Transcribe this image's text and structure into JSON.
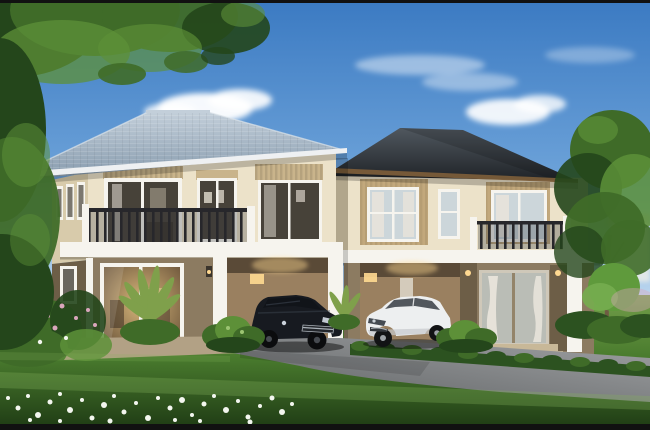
{
  "meta": {
    "title": "Architectural rendering: twin two-storey houses with carports",
    "width": 650,
    "height": 430
  },
  "scene": {
    "objects": [
      "blue sky with clouds",
      "overhanging tree top-left",
      "left two-storey house with light blue-grey hip roof and balcony",
      "right two-storey house with dark charcoal hip roof and balcony",
      "black sedan parked in left carport",
      "white sedan parked in right carport",
      "glowing glass sliding doors",
      "green lawn with white flower bed",
      "grey driveway with hedge row",
      "garden shrubs and tree on right"
    ]
  },
  "colors": {
    "border": "#111111",
    "sky_top": "#3b7ac2",
    "sky_mid": "#71a6db",
    "sky_low": "#d7e8f6",
    "cloud": "#ffffff",
    "distant": "#e7eae8",
    "roof_left_hi": "#c3cfda",
    "roof_left_lo": "#8599ac",
    "roof_left_fascia": "#eef0f2",
    "roof_right_hi": "#50585f",
    "roof_right_lo": "#1f2327",
    "fascia_brown": "#7a5c39",
    "trim_white": "#f6f4ee",
    "wall_cream": "#ece2c9",
    "wall_cream_shade": "#d8cbab",
    "frieze_tan": "#c9b48b",
    "panel_tan": "#c2a87c",
    "railing": "#27272b",
    "glass_cool": "#ccd6da",
    "glass_dark": "#474239",
    "curtain": "#e9e4da",
    "wall_taupe": "#8c7b61",
    "wall_taupe_dark": "#6d5e47",
    "carport_wall": "#9a8060",
    "carport_shadow": "#4f4130",
    "door_glow_in": "#d9b87c",
    "door_glow_out": "#6e573c",
    "lamp": "#ffd991",
    "lawn_top": "#739e4a",
    "lawn_mid": "#4a7c2e",
    "lawn_dark": "#1e3a14",
    "lawn_streak": "#86b45c",
    "hedge": "#2c5220",
    "drive_light": "#9fa1a3",
    "drive_dark": "#606365",
    "patio": "#b2a185",
    "steps": "#c8b898",
    "flower": "#f3f6ef",
    "flower_pink": "#d9a6bc",
    "tree_dark": "#24461b",
    "tree_mid": "#3f6b28",
    "tree_light": "#5d9038",
    "palm": "#7fa04b",
    "trunk": "#6f5c43",
    "car_black": "#171a20",
    "car_black_glass": "#111419",
    "car_black_hi": "#3c434e",
    "car_white": "#edeff0",
    "car_white_shade": "#c6c9cc",
    "car_glass": "#40464d",
    "chrome": "#aab1b8",
    "shadow": "#000000"
  }
}
